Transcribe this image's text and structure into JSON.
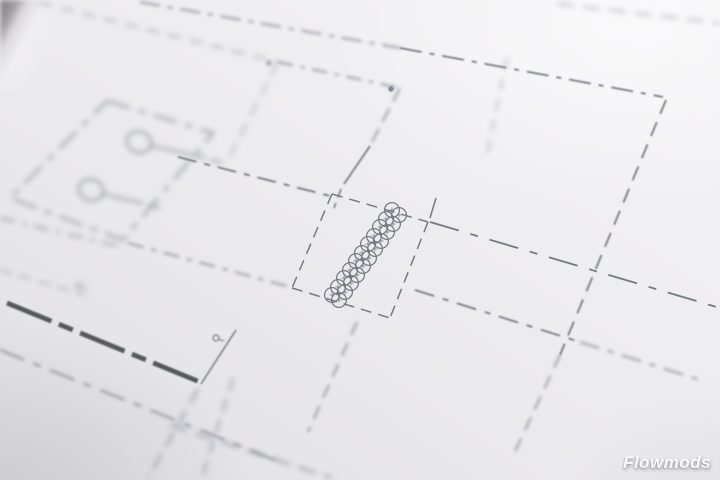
{
  "watermark": {
    "text": "Flowmods"
  },
  "palette": {
    "paper_light": "#f5f4f6",
    "paper_mid": "#e9e8ec",
    "paper_dark": "#e0dfe3",
    "line_faint": "#b2b6bd",
    "line_medium": "#979da5",
    "line_sharp": "#747a82",
    "line_thick": "#54575d",
    "corner_shadow": "#747075",
    "watermark_color": "#ffffff"
  }
}
